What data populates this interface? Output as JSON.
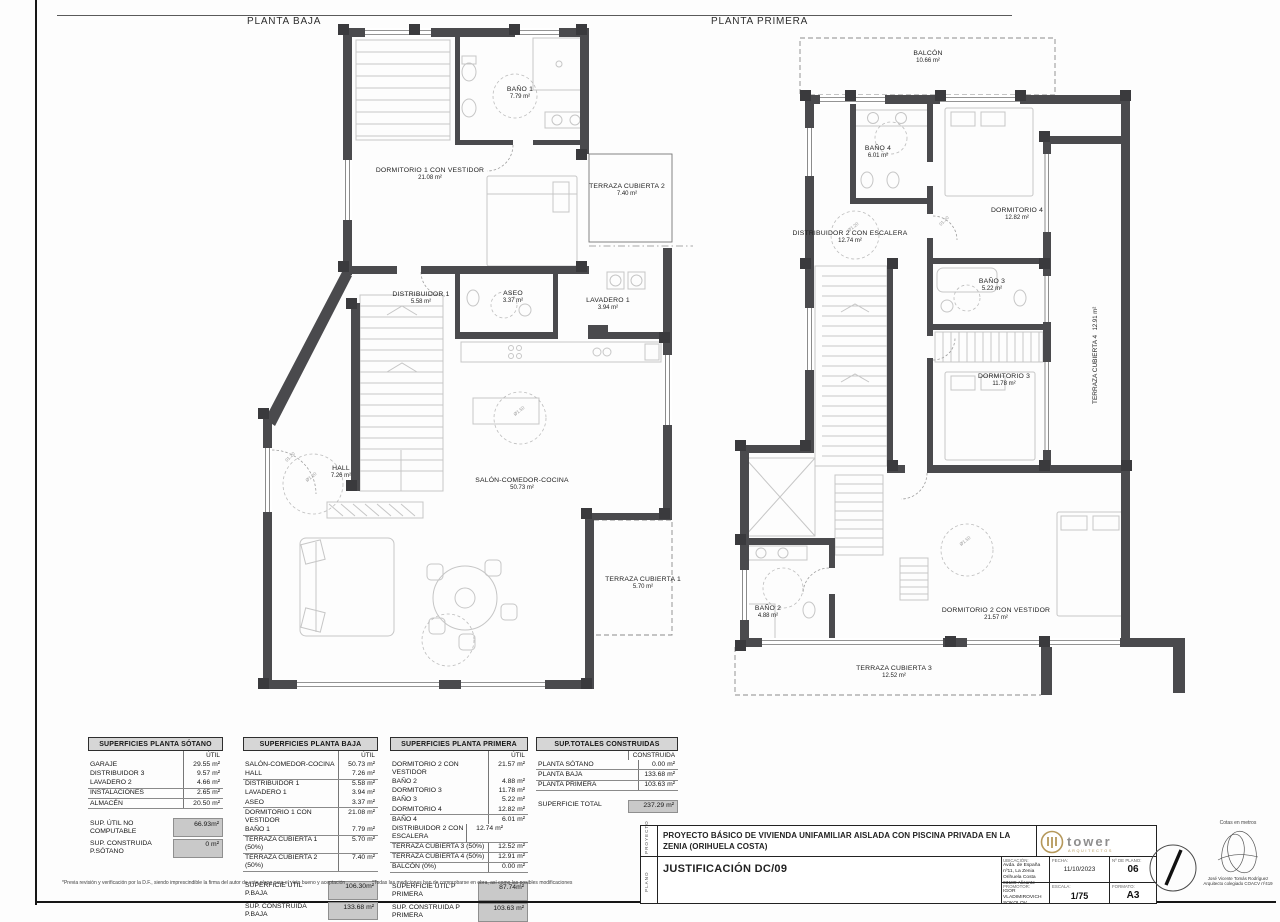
{
  "plans": {
    "baja": {
      "title": "PLANTA BAJA",
      "rooms": [
        {
          "name": "BAÑO 1",
          "area": "7.79 m²"
        },
        {
          "name": "DORMITORIO 1 CON VESTIDOR",
          "area": "21.08 m²"
        },
        {
          "name": "TERRAZA CUBIERTA 2",
          "area": "7.40 m²"
        },
        {
          "name": "DISTRIBUIDOR 1",
          "area": "5.58 m²"
        },
        {
          "name": "ASEO",
          "area": "3.37 m²"
        },
        {
          "name": "LAVADERO 1",
          "area": "3.94 m²"
        },
        {
          "name": "HALL",
          "area": "7.26 m²"
        },
        {
          "name": "SALÓN-COMEDOR-COCINA",
          "area": "50.73 m²"
        },
        {
          "name": "TERRAZA CUBIERTA 1",
          "area": "5.70 m²"
        }
      ]
    },
    "primera": {
      "title": "PLANTA PRIMERA",
      "rooms": [
        {
          "name": "BALCÓN",
          "area": "10.66 m²"
        },
        {
          "name": "BAÑO 4",
          "area": "6.01 m²"
        },
        {
          "name": "DORMITORIO 4",
          "area": "12.82 m²"
        },
        {
          "name": "DISTRIBUIDOR 2 CON ESCALERA",
          "area": "12.74 m²"
        },
        {
          "name": "BAÑO 3",
          "area": "5.22 m²"
        },
        {
          "name": "DORMITORIO 3",
          "area": "11.78 m²"
        },
        {
          "name": "TERRAZA CUBIERTA 4",
          "area": "12.91 m²"
        },
        {
          "name": "BAÑO 2",
          "area": "4.88 m²"
        },
        {
          "name": "DORMITORIO 2 CON VESTIDOR",
          "area": "21.57 m²"
        },
        {
          "name": "TERRAZA CUBIERTA 3",
          "area": "12.52 m²"
        }
      ]
    },
    "annotations": {
      "door": "01.20",
      "circle_large": "Ø1.50",
      "circle_small": "Ø1.20"
    }
  },
  "tables": {
    "sotano": {
      "title": "SUPERFICIES PLANTA SÓTANO",
      "col": "ÚTIL",
      "rows": [
        {
          "label": "GARAJE",
          "value": "29.55 m²"
        },
        {
          "label": "DISTRIBUIDOR 3",
          "value": "9.57 m²"
        },
        {
          "label": "LAVADERO 2",
          "value": "4.66 m²"
        },
        {
          "label": "INSTALACIONES",
          "value": "2.65 m²"
        },
        {
          "label": "ALMACÉN",
          "value": "20.50 m²"
        }
      ],
      "totals": [
        {
          "label": "SUP. ÚTIL NO COMPUTABLE",
          "value": "66.93m²"
        },
        {
          "label": "SUP. CONSTRUIDA P.SÓTANO",
          "value": "0 m²"
        }
      ]
    },
    "baja": {
      "title": "SUPERFICIES PLANTA BAJA",
      "col": "ÚTIL",
      "rows": [
        {
          "label": "SALÓN-COMEDOR-COCINA",
          "value": "50.73 m²"
        },
        {
          "label": "HALL",
          "value": "7.26 m²"
        },
        {
          "label": "DISTRIBUIDOR 1",
          "value": "5.58 m²"
        },
        {
          "label": "LAVADERO 1",
          "value": "3.94 m²"
        },
        {
          "label": "ASEO",
          "value": "3.37 m²"
        },
        {
          "label": "DORMITORIO 1 CON VESTIDOR",
          "value": "21.08 m²"
        },
        {
          "label": "BAÑO 1",
          "value": "7.79 m²"
        },
        {
          "label": "TERRAZA CUBIERTA 1 (50%)",
          "value": "5.70 m²"
        },
        {
          "label": "TERRAZA CUBIERTA 2 (50%)",
          "value": "7.40 m²"
        }
      ],
      "totals": [
        {
          "label": "SUPERFICIE ÚTIL P.BAJA",
          "value": "106.30m²"
        },
        {
          "label": "SUP. CONSTRUIDA P.BAJA",
          "value": "133.68 m²"
        }
      ]
    },
    "primera": {
      "title": "SUPERFICIES PLANTA PRIMERA",
      "col": "ÚTIL",
      "rows": [
        {
          "label": "DORMITORIO 2 CON VESTIDOR",
          "value": "21.57 m²"
        },
        {
          "label": "BAÑO 2",
          "value": "4.88 m²"
        },
        {
          "label": "DORMITORIO 3",
          "value": "11.78 m²"
        },
        {
          "label": "BAÑO 3",
          "value": "5.22 m²"
        },
        {
          "label": "DORMITORIO 4",
          "value": "12.82 m²"
        },
        {
          "label": "BAÑO 4",
          "value": "6.01 m²"
        },
        {
          "label": "DISTRIBUIDOR 2 CON ESCALERA",
          "value": "12.74 m²"
        },
        {
          "label": "TERRAZA CUBIERTA 3 (50%)",
          "value": "12.52 m²"
        },
        {
          "label": "TERRAZA CUBIERTA 4 (50%)",
          "value": "12.91 m²"
        },
        {
          "label": "BALCÓN (0%)",
          "value": "0.00 m²"
        }
      ],
      "totals": [
        {
          "label": "SUPERFICIE ÚTIL P PRIMERA",
          "value": "87.74m²"
        },
        {
          "label": "SUP. CONSTRUIDA P PRIMERA",
          "value": "103.63 m²"
        }
      ]
    },
    "totales": {
      "title": "SUP.TOTALES CONSTRUIDAS",
      "col": "CONSTRUIDA",
      "rows": [
        {
          "label": "PLANTA SÓTANO",
          "value": "0.00 m²"
        },
        {
          "label": "PLANTA BAJA",
          "value": "133.68 m²"
        },
        {
          "label": "PLANTA PRIMERA",
          "value": "103.63 m²"
        }
      ],
      "totals": [
        {
          "label": "SUPERFICIE TOTAL",
          "value": "237.29 m²"
        }
      ]
    }
  },
  "footnotes": {
    "left": "*Previa revisión y verificación por la D.F., siendo imprescindible la firma del autor de este plano para el visto bueno y aceptación",
    "right": "*Todas las mediciones han de comprobarse en obra, así como las posibles modificaciones"
  },
  "titleblock": {
    "proyecto_label": "PROYECTO",
    "plano_label": "PLANO",
    "project_title": "PROYECTO BÁSICO DE VIVIENDA UNIFAMILIAR AISLADA CON PISCINA PRIVADA EN LA ZENIA (ORIHUELA COSTA)",
    "plano_value": "JUSTIFICACIÓN DC/09",
    "ubicacion_label": "UBICACIÓN:",
    "ubicacion_line1": "Avda. de España nº11, La Zenia",
    "ubicacion_line2": "Orihuela Costa 03189 Alicante",
    "promotor_label": "PROMOTOR:",
    "promotor_value": "IGOR VLADIMIROVICH SOKOLOV",
    "fecha_label": "FECHA:",
    "fecha_value": "11/10/2023",
    "num_label": "Nº DE PLANO:",
    "num_value": "06",
    "escala_label": "ESCALA:",
    "escala_value": "1/75",
    "formato_label": "FORMATO:",
    "formato_value": "A3",
    "logo_text": "tower",
    "logo_sub": "ARQUITECTOS",
    "cotas": "Cotas en metros",
    "architect_line1": "José Vicente Tomás Rodríguez",
    "architect_line2": "Arquitecto colegiado COACV nº419"
  }
}
